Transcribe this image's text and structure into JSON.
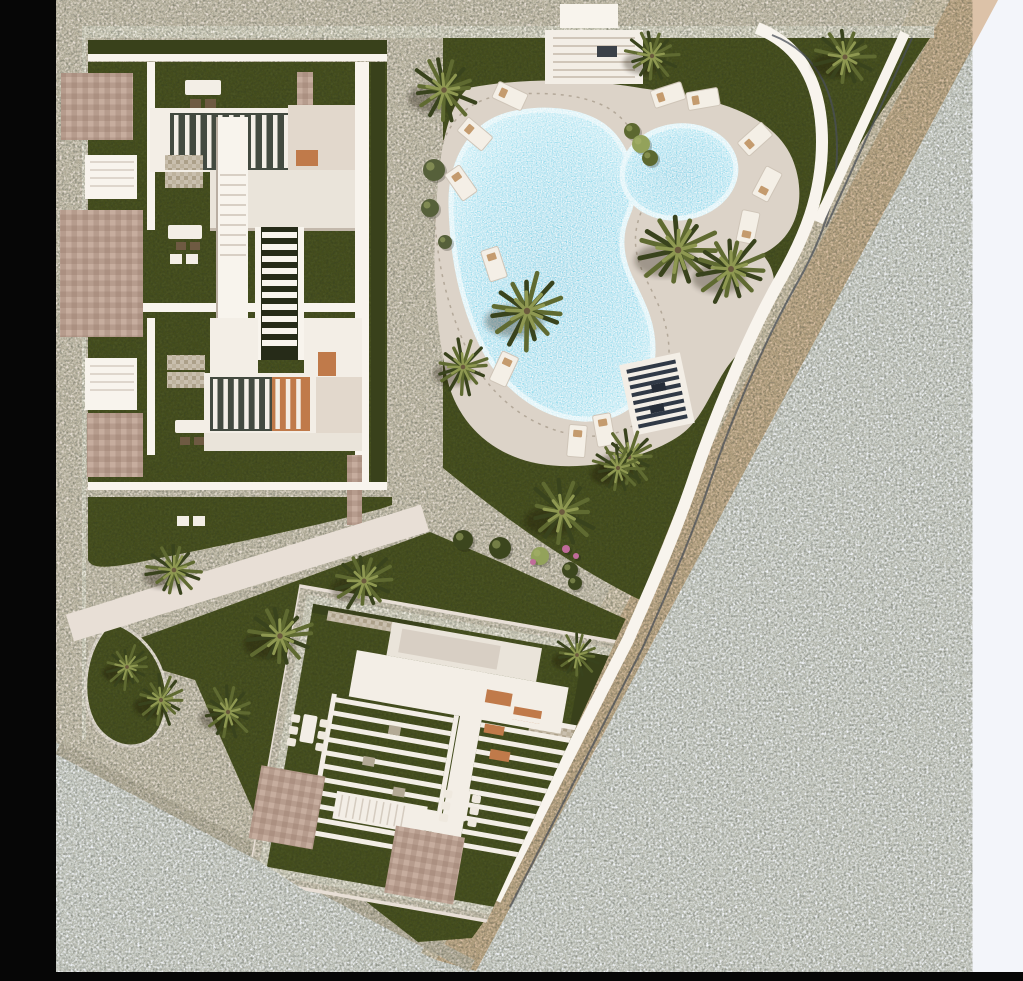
{
  "scene": {
    "title": "Residential complex masterplan - top-down render",
    "type": "architectural-site-plan",
    "view": "aerial-top-down"
  },
  "palette": {
    "background": "#f3f5fa",
    "frame": "#060606",
    "paving": "#e8dfd6",
    "paving_shadow": "#d6ccc1",
    "path_white": "#f8f4ed",
    "walk_light": "#e9dccd",
    "walk_tan": "#dcc2a8",
    "curb_dark": "#4a4f57",
    "lawn": "#4c5525",
    "lawn_dark": "#3c451c",
    "hedge": "#39411b",
    "pool_deep": "#55c7e0",
    "pool_mid": "#74d4e9",
    "pool_shallow": "#b9e9f3",
    "waterline": "#cdeef5",
    "deck": "#dcd3c8",
    "roof_white": "#f3eee6",
    "roof_light": "#eae4da",
    "roof_cream": "#e2d8cc",
    "slat_dark": "#434a40",
    "brick": "#b69c8d",
    "brick_light": "#c6ad9e",
    "gravel": "#c9bfae",
    "terracotta": "#c07a4a",
    "pergola_slat": "#303946",
    "palm_dark": "#39431d",
    "palm_mid": "#5f6a31",
    "palm_light": "#8e9851",
    "trunk": "#6b5a3e",
    "bush_light": "#93a25b",
    "flower_pink": "#c06c9a",
    "shadow": "#1d1a10"
  },
  "features": {
    "buildings": [
      "north-residential-block",
      "south-residential-block"
    ],
    "amenities": [
      "main-swimming-pool",
      "kids-pool",
      "sun-deck",
      "pergola-deck",
      "entrance-stairs",
      "garden-paths",
      "brick-patios",
      "roof-pergolas"
    ],
    "palm_count": 17,
    "lounger_count": 12,
    "pool_count": 2,
    "dining_table_count": 2
  },
  "vegetation": {
    "palms": [
      [
        444,
        90,
        1.25
      ],
      [
        652,
        56,
        1.0
      ],
      [
        845,
        57,
        1.15
      ],
      [
        678,
        250,
        1.5
      ],
      [
        731,
        269,
        1.35
      ],
      [
        527,
        311,
        1.45
      ],
      [
        463,
        367,
        1.05
      ],
      [
        629,
        457,
        1.05
      ],
      [
        562,
        512,
        1.3
      ],
      [
        618,
        468,
        0.95
      ],
      [
        174,
        570,
        1.05
      ],
      [
        280,
        636,
        1.25
      ],
      [
        364,
        581,
        1.15
      ],
      [
        127,
        667,
        0.85
      ],
      [
        161,
        700,
        0.95
      ],
      [
        228,
        712,
        1.0
      ],
      [
        577,
        655,
        0.85
      ]
    ],
    "bushes": [
      [
        632,
        131,
        8,
        "mid"
      ],
      [
        641,
        144,
        9,
        "light"
      ],
      [
        650,
        158,
        8,
        "mid"
      ],
      [
        463,
        540,
        10,
        "dark"
      ],
      [
        500,
        548,
        11,
        "dark"
      ],
      [
        540,
        556,
        9,
        "light"
      ],
      [
        570,
        570,
        8,
        "dark"
      ],
      [
        575,
        583,
        7,
        "dark"
      ],
      [
        434,
        170,
        11,
        "olive"
      ],
      [
        430,
        208,
        9,
        "olive"
      ],
      [
        445,
        242,
        7,
        "olive"
      ],
      [
        566,
        549,
        4,
        "pink"
      ],
      [
        576,
        556,
        3,
        "pink"
      ],
      [
        533,
        562,
        3,
        "pink"
      ]
    ]
  },
  "furniture": {
    "loungers": [
      [
        510,
        96,
        25
      ],
      [
        475,
        134,
        40
      ],
      [
        461,
        183,
        55
      ],
      [
        494,
        264,
        72
      ],
      [
        504,
        369,
        115
      ],
      [
        577,
        441,
        95
      ],
      [
        604,
        430,
        80
      ],
      [
        668,
        95,
        -18
      ],
      [
        703,
        99,
        -10
      ],
      [
        755,
        139,
        -42
      ],
      [
        767,
        184,
        -62
      ],
      [
        748,
        227,
        -78
      ]
    ]
  }
}
